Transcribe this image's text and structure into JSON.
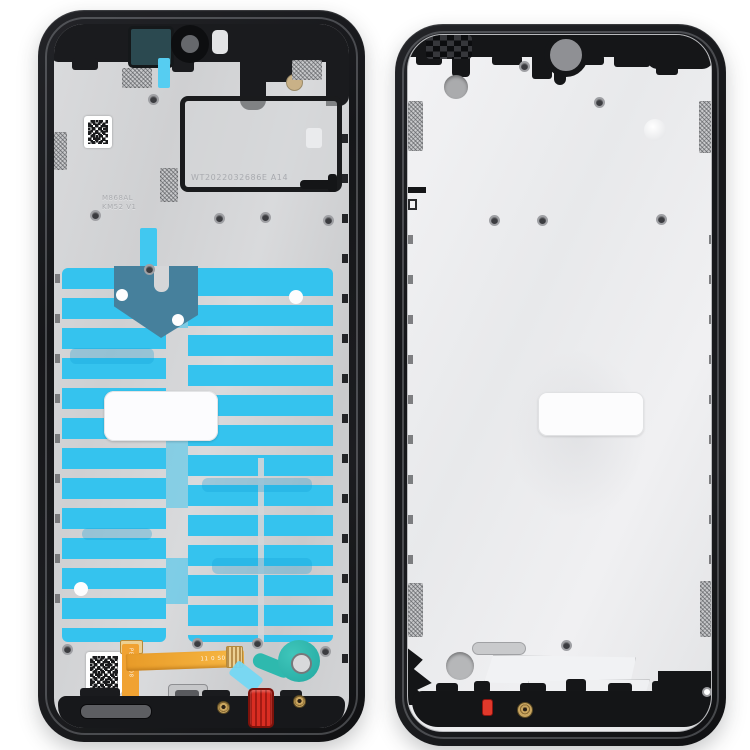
{
  "image": {
    "type": "product-photo",
    "subject": "Smartphone front housing LCD frame bezel plate, inner side (left) and front side (right)",
    "background_color": "#ffffff"
  },
  "left_frame": {
    "view": "inner side with adhesive stickers and flex cable",
    "frame_color": "#1b1c1f",
    "plate_color": "#d5d6d8",
    "markings": {
      "battery_window_code": "WT2022032686E A14",
      "embossed_line1": "M868AL",
      "embossed_line2": "KM52 V1",
      "flex_cable_code": "11 0 S0001",
      "flex_cable_side_code": "PBH3208"
    },
    "colors": {
      "adhesive_cyan": "#35c3ee",
      "graphite_film_blue": "#46809c",
      "camera_bracket_teal": "#2b4950",
      "fingerprint_disc_teal": "#2eb9ae",
      "flex_cable_orange": "#f0a232",
      "seal_plug_red": "#d92d22",
      "adhesive_tab_blue": "#74d7f3"
    },
    "parts": [
      "qr-code-sticker",
      "battery-window",
      "adhesive-comb-sticker",
      "graphite-film",
      "lcd-window-cutout",
      "speaker-flex-cable",
      "fingerprint-adhesive-disc",
      "charging-port",
      "red-seal-plug",
      "speaker-slot"
    ]
  },
  "right_frame": {
    "view": "front side, empty LCD support plate with waterdrop notch",
    "frame_color": "#151618",
    "plate_color": "#eceded",
    "colors": {
      "seal_plug_red": "#e0392b",
      "screw_gold": "#caa768",
      "notch_hole_gray": "#8f9094"
    },
    "parts": [
      "notch-camera-hole",
      "top-grille",
      "side-mesh-pads",
      "lcd-window-cutout",
      "drain-slot",
      "bottom-hole",
      "red-seal-plug",
      "gold-screw"
    ]
  }
}
